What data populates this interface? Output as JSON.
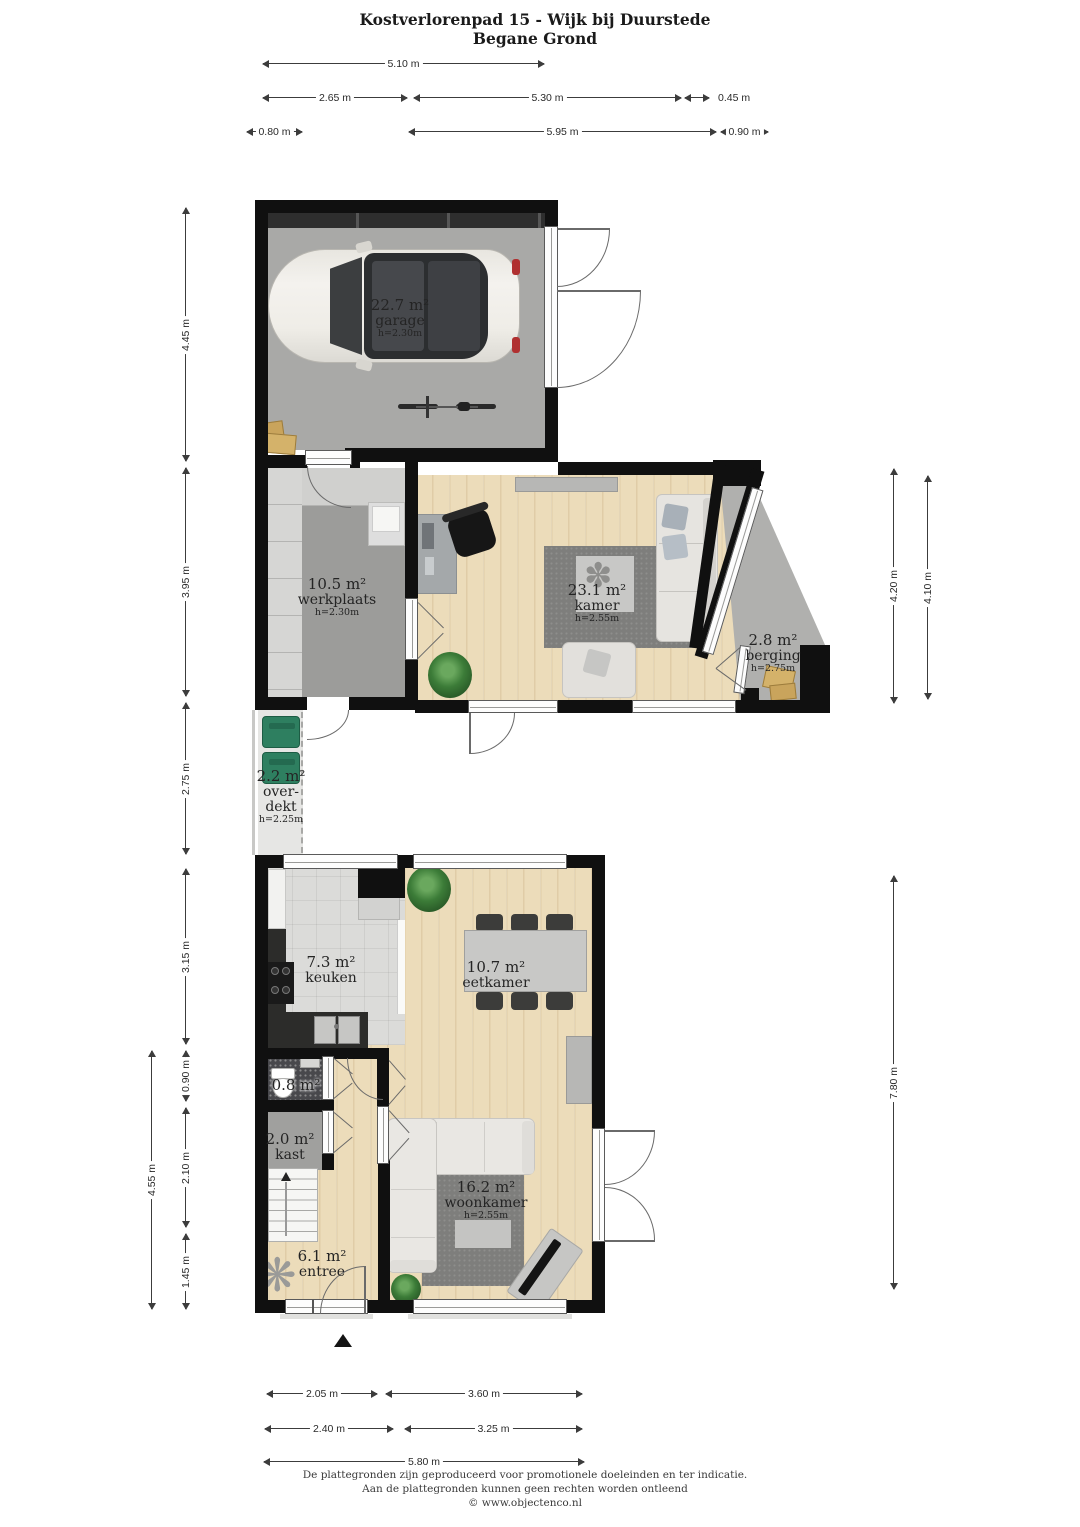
{
  "title": {
    "line1": "Kostverlorenpad 15 - Wijk bij Duurstede",
    "line2": "Begane Grond"
  },
  "rooms": {
    "garage": {
      "area": "22.7 m²",
      "name": "garage",
      "height": "h=2.30m"
    },
    "werkplaats": {
      "area": "10.5 m²",
      "name": "werkplaats",
      "height": "h=2.30m"
    },
    "kamer": {
      "area": "23.1 m²",
      "name": "kamer",
      "height": "h=2.55m"
    },
    "berging": {
      "area": "2.8 m²",
      "name": "berging",
      "height": "h=2.75m"
    },
    "overdekt": {
      "area": "2.2 m²",
      "name_line1": "over-",
      "name_line2": "dekt",
      "height": "h=2.25m"
    },
    "keuken": {
      "area": "7.3 m²",
      "name": "keuken"
    },
    "eetkamer": {
      "area": "10.7 m²",
      "name": "eetkamer"
    },
    "toilet": {
      "area": "0.8 m²"
    },
    "kast": {
      "area": "2.0 m²",
      "name": "kast"
    },
    "woonkamer": {
      "area": "16.2 m²",
      "name": "woonkamer",
      "height": "h=2.55m"
    },
    "entree": {
      "area": "6.1 m²",
      "name": "entree"
    }
  },
  "dims": {
    "top": {
      "d510": "5.10 m",
      "d265": "2.65 m",
      "d530": "5.30 m",
      "d045": "0.45 m",
      "d080": "0.80 m",
      "d595": "5.95 m",
      "d090": "0.90 m"
    },
    "left": {
      "d445": "4.45 m",
      "d395": "3.95 m",
      "d275": "2.75 m",
      "d315": "3.15 m",
      "d090": "0.90 m",
      "d210": "2.10 m",
      "d145": "1.45 m",
      "d455": "4.55 m"
    },
    "right": {
      "d420": "4.20 m",
      "d410": "4.10 m",
      "d780": "7.80 m"
    },
    "bottom": {
      "d205": "2.05 m",
      "d360": "3.60 m",
      "d240": "2.40 m",
      "d325": "3.25 m",
      "d580": "5.80 m"
    }
  },
  "footer": {
    "line1": "De plattegronden zijn geproduceerd voor promotionele doeleinden en ter indicatie.",
    "line2": "Aan de plattegronden kunnen geen rechten worden ontleend",
    "line3": "© www.objectenco.nl"
  },
  "colors": {
    "wall": "#101010",
    "wood_floor": "#ecdcba",
    "concrete_floor": "#a9a9a7",
    "rug": "#7e7e7c",
    "bin_green": "#2e7f60",
    "box_tan": "#c9a45c"
  }
}
